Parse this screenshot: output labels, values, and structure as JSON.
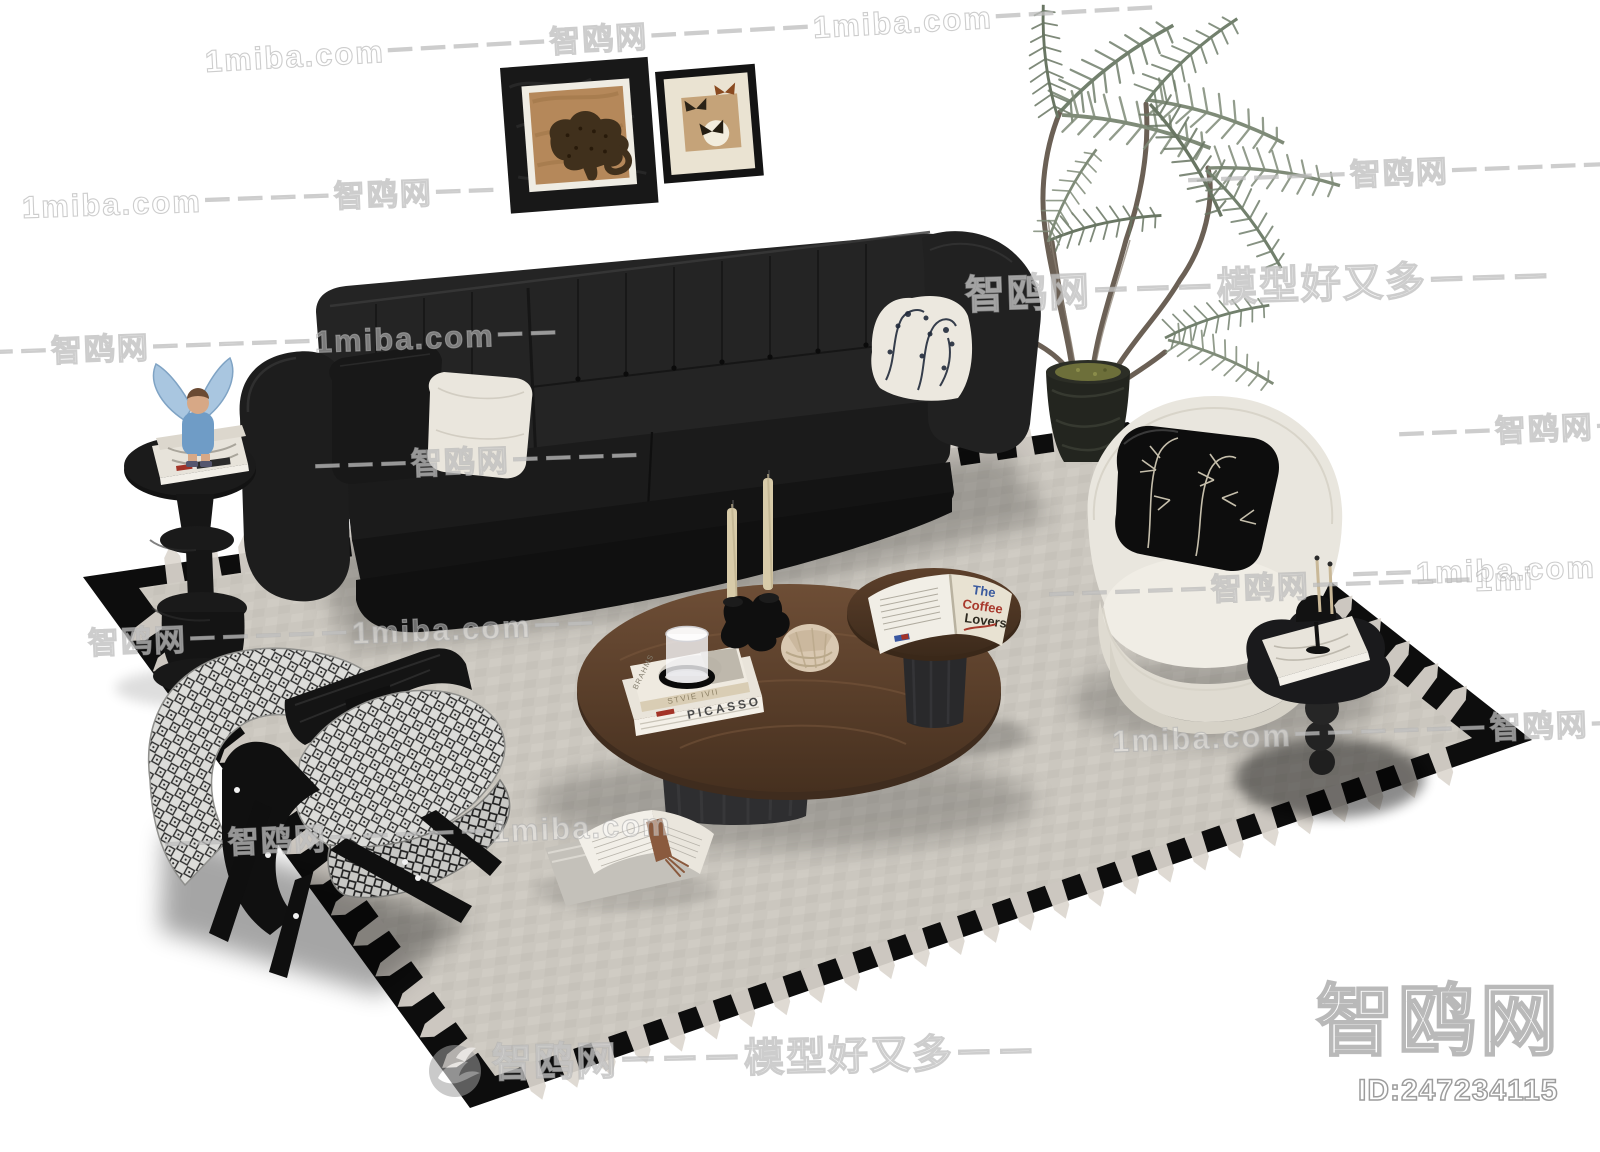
{
  "canvas": {
    "width": 1600,
    "height": 1152,
    "background": "#ffffff"
  },
  "watermarks": {
    "site_en": "1miba.com",
    "site_cn": "智鸥网",
    "slogan": "模型好又多",
    "rows": [
      "1miba.com－－－－－智鸥网－－－－－1miba.com－－－－－",
      "1miba.com－－－－智鸥网－－",
      "－－－－－智鸥网－－－－－",
      "－－智鸥网－－－－－1miba.com－－",
      "－－－智鸥网－－－－",
      "－－－智鸥网－",
      "－－1miba.com",
      "智鸥网－－－－－1miba.com－－",
      "－－－－－智鸥网－－－－－1mi",
      "－－智鸥网－－－－－1miba.com",
      "1miba.com－－－－－－智鸥网－－"
    ],
    "slogan_row_upper": "智鸥网－－－模型好又多－－－",
    "slogan_row_lower": "智鸥网－－－模型好又多－－",
    "brand_large": "智鸥网",
    "model_id": "ID:247234115"
  },
  "artworks": {
    "picasso_spine": "PICASSO",
    "brahms_cover": "BRAHMS",
    "top_book_band_text": "STVIE IVII",
    "coffee_line1": "The",
    "coffee_line2": "Coffee",
    "coffee_line3": "Lovers"
  },
  "icons": {
    "bird_logo": "seagull-brand-logo"
  },
  "colors": {
    "sofa_black": "#222222",
    "rug_border": "#0d0d0d",
    "rug_field": "#ccc8c0",
    "table_wood": "#5e452f",
    "armchair_cream": "#e9e6de",
    "plant_green": "#78846f",
    "watermark_gray": "#bdbdbd",
    "angel_blue": "#7fa6cb",
    "candle_beige": "#d8cba9"
  }
}
